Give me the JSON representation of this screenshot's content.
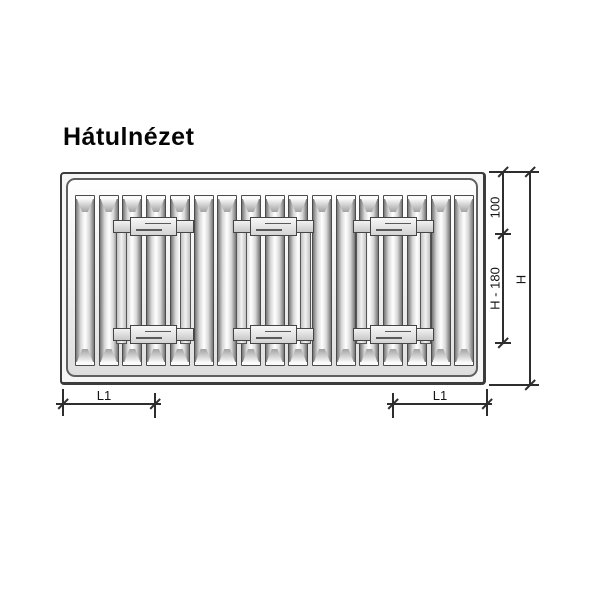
{
  "labels": {
    "title": "Hátulnézet",
    "dim_top_offset": "100",
    "dim_bracket_span": "H - 180",
    "dim_total_height": "H",
    "dim_left_offset": "L1",
    "dim_right_offset": "L1"
  },
  "colors": {
    "line": "#2e2e2e",
    "frame": "#3c3c3c",
    "metal_dark": "#767676",
    "metal_light": "#ffffff",
    "clamp_fill": "#e6e6e6"
  },
  "diagram": {
    "fin_count": 17,
    "fin_start_x": 13,
    "fin_pitch": 23.7,
    "fin_width": 20,
    "fin_top": 21,
    "fin_height": 171,
    "bracket_xs": [
      51,
      171,
      291
    ],
    "bracket_width": 81,
    "rail_inset": 3,
    "rail_width": 11,
    "rail_top": 46,
    "rail_height": 124,
    "clamp_top_y": 43,
    "clamp_bottom_y": 151,
    "clamp_height": 19,
    "clamp_end_dy": 3,
    "clamp_end_height": 13,
    "clamp_center_inset": 17
  }
}
